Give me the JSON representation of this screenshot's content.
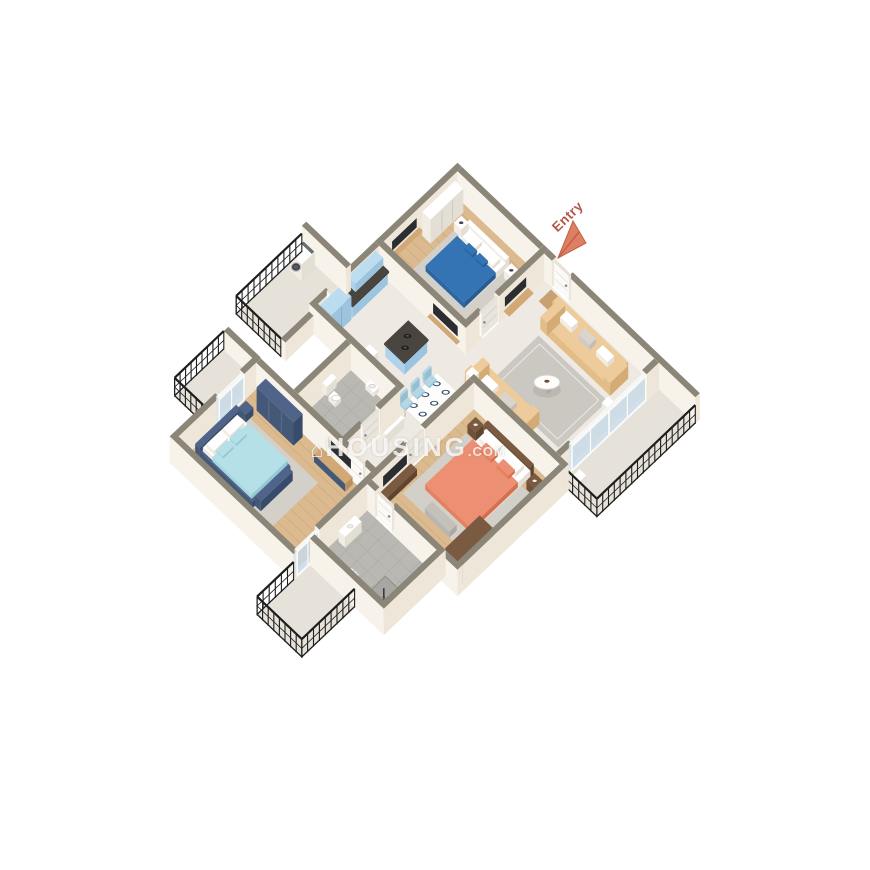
{
  "scene": {
    "description": "3D isometric floor plan render of a 3-bedroom apartment",
    "rooms": [
      "bedroom-1",
      "kitchen",
      "utility-balcony",
      "living-room",
      "dining-area",
      "corridor",
      "common-bathroom",
      "side-balcony",
      "master-bedroom",
      "master-bathroom",
      "bedroom-2",
      "right-balcony",
      "bottom-balcony"
    ],
    "objects": [
      "double-bed-blue",
      "double-bed-coral",
      "double-bed-aqua",
      "sofa",
      "coffee-table",
      "dining-table",
      "dining-chairs",
      "kitchen-island",
      "cooktop",
      "washing-machine",
      "wardrobe",
      "tv-unit",
      "toilet",
      "wash-basin",
      "shower",
      "balcony-railing",
      "entry-door",
      "sliding-glass-door",
      "doormat"
    ]
  },
  "entry": {
    "label": "Entry"
  },
  "watermark": {
    "logo_glyph": "⌂",
    "name": "HOUSING",
    "tld": ".COM"
  },
  "palette": {
    "wallTop": "#8c8678",
    "wallLight": "#f8f3ea",
    "wallShade": "#eee7d9",
    "floorWood": "#dcba90",
    "floorWoodLine": "#b07f51",
    "floorMarble": "#eeeae3",
    "floorTile": "#bab8b2",
    "floorTileLine": "#a3a19b",
    "floorConcrete": "#e6e2d9",
    "railing": "#1e1e1e",
    "doorFace": "#fbfaf6",
    "doorSide": "#e9e5dc",
    "doorTop": "#e6e2d8",
    "glassS": "rgba(215,229,238,0.85)",
    "glassE": "rgba(200,217,229,0.85)",
    "glassTop": "#f7f7f5",
    "bedBlueTop": "#3474b4",
    "bedBlueS": "#2d67a3",
    "bedBlueE": "#285c93",
    "bedCoralTop": "#ec8f72",
    "bedCoralS": "#e5815f",
    "bedCoralE": "#d76f4e",
    "bedAquaTop": "#b5e0e8",
    "bedAquaS": "#a7d8e2",
    "bedAquaE": "#93c9d6",
    "navyTop": "#50648a",
    "navyS": "#445877",
    "navyE": "#394b6b",
    "brownTop": "#7a5a40",
    "brownS": "#6f5138",
    "brownE": "#5f452f",
    "woodTanTop": "#d2a876",
    "woodTanS": "#c89e6c",
    "woodTanE": "#b98f5f",
    "cabBlueTop": "#bcdcf0",
    "cabBlueS": "#aed3ea",
    "cabBlueE": "#9cc4de",
    "counterTop": "#4a443e",
    "counterS": "#403a34",
    "counterE": "#362f2a",
    "sofaTop": "#edcb9b",
    "sofaS": "#e3bd88",
    "sofaE": "#d3ab74",
    "whiteTop": "#ffffff",
    "whiteS": "#f1ede4",
    "whiteE": "#e4dfd4",
    "grayTop": "#c4c1bb",
    "grayS": "#b9b6b0",
    "grayE": "#aca9a3",
    "chairTop": "#b3d7e4",
    "chairS": "#a5cede",
    "chairE": "#95bfd1",
    "rug": "#cbc8c1",
    "rugBed": "#d3d0c9",
    "tv": "#2b2d30",
    "steel": "#8a8f94",
    "arrow": "#dd7f63",
    "arrowDeep": "#c35f45",
    "entryText": "#b5584a",
    "watermarkColor": "rgba(255,255,255,0.78)"
  }
}
